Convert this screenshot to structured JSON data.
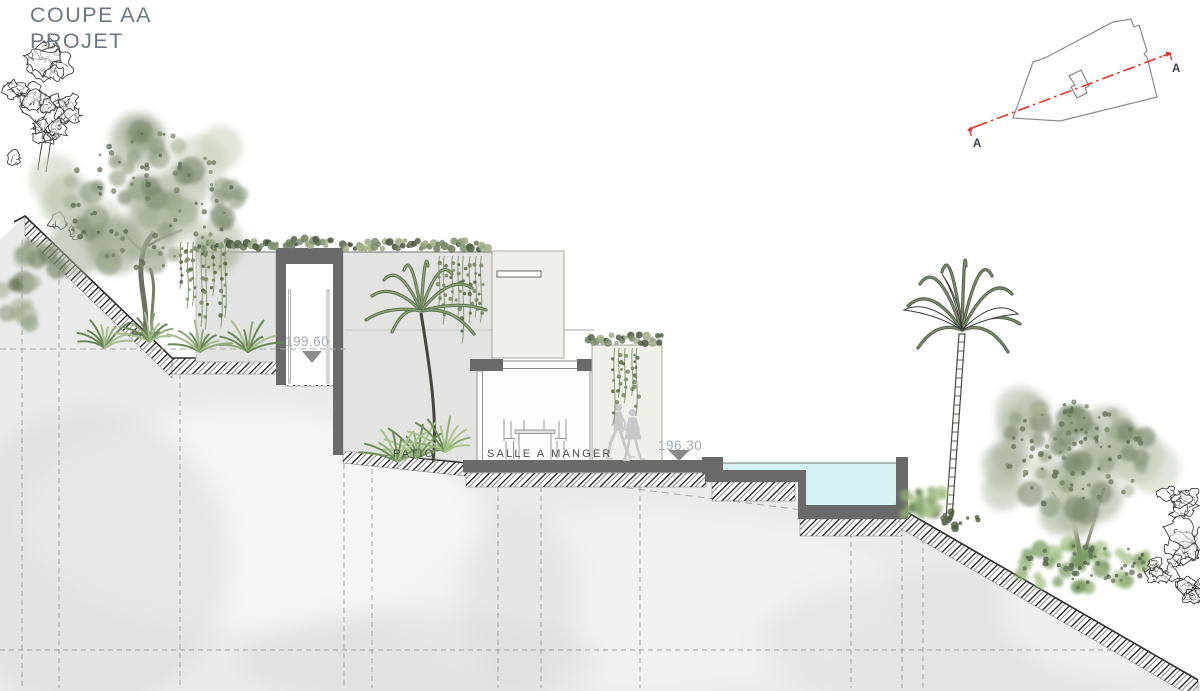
{
  "title": {
    "line1": "COUPE AA",
    "line2": "PROJET"
  },
  "elevation_markers": {
    "upper": "199.60",
    "lower": "196.30"
  },
  "room_labels": {
    "patio": "PATIO",
    "dining": "SALLE A MANGER"
  },
  "site_plan": {
    "label_a_left": "A",
    "label_a_right": "A"
  },
  "colors": {
    "section_cut": "#6a6a6a",
    "wall_light": "#e3e3e1",
    "wall_beige": "#f1efe9",
    "pool_water": "#d5f3f4",
    "section_line_red": "#e8302a",
    "elevation_text": "#a2aab4",
    "title_text": "#6b7880",
    "label_text": "#4f4f4f",
    "hatch": "#1c1c1c",
    "ground": "#eaeaea"
  }
}
